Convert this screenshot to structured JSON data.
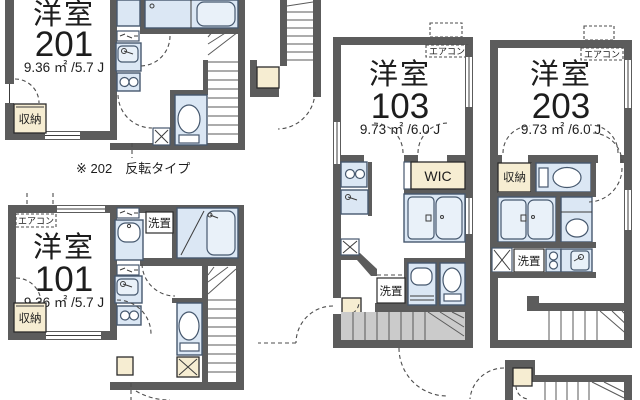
{
  "plan": {
    "title": "apartment-floor-plan",
    "note_202": "※ 202　反転タイプ",
    "labels": {
      "aircon": "エアコン",
      "closet": "収納",
      "laundry": "洗置",
      "wic": "WIC"
    },
    "units": {
      "u201": {
        "type": "洋室",
        "number": "201",
        "area": "9.36 ㎡ /5.7 J"
      },
      "u101": {
        "type": "洋室",
        "number": "101",
        "area": "9.36 ㎡ /5.7 J"
      },
      "u103": {
        "type": "洋室",
        "number": "103",
        "area": "9.73 ㎡ /6.0 J"
      },
      "u203": {
        "type": "洋室",
        "number": "203",
        "area": "9.73 ㎡ /6.0 J"
      }
    },
    "colors": {
      "wall": "#5c5c5c",
      "fixture": "#dbe7f4",
      "closet": "#f6edd2",
      "stairs": "#cbcbcb",
      "background": "#ffffff"
    }
  }
}
